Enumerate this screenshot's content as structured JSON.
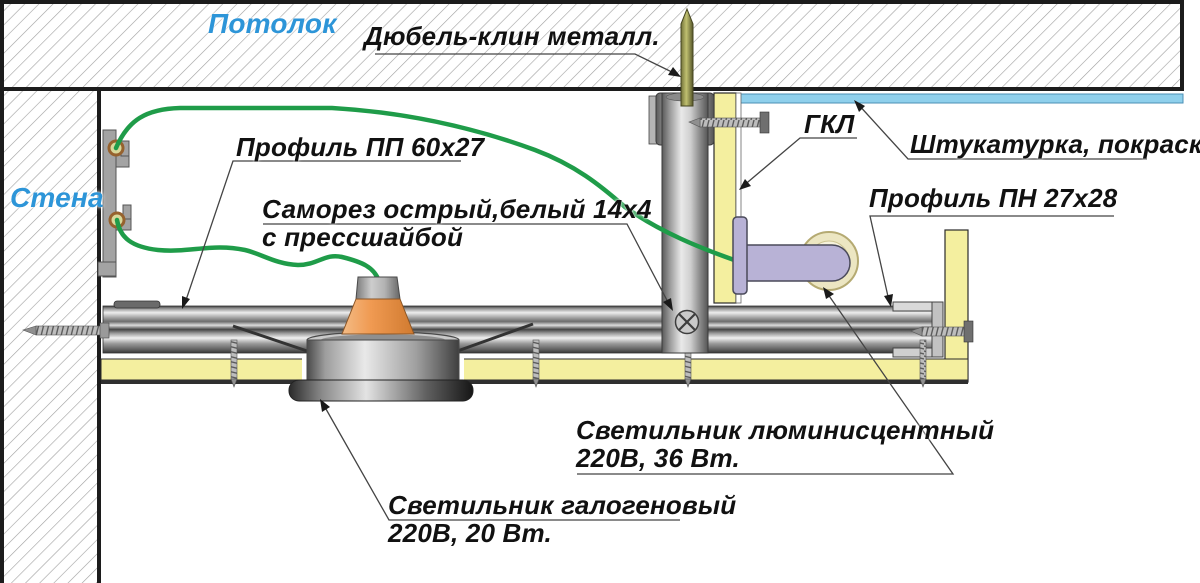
{
  "labels": {
    "ceiling": "Потолок",
    "wall": "Стена",
    "dowel": "Дюбель-клин металл.",
    "profile_pp": "Профиль ПП 60х27",
    "screw_line1": "Саморез острый,белый 14х4",
    "screw_line2": "с прессшайбой",
    "gkl": "ГКЛ",
    "plaster": "Штукатурка, покраска",
    "profile_pn": "Профиль ПН 27х28",
    "fluorescent_line1": "Светильник люминисцентный",
    "fluorescent_line2": "220В, 36 Вт.",
    "halogen_line1": "Светильник галогеновый",
    "halogen_line2": "220В, 20 Вт."
  },
  "colors": {
    "label_blue": "#2d95d8",
    "wire_green": "#1f9c49",
    "gypsum_yellow": "#f4ef9f",
    "plaster_blue": "#8fd0ec",
    "lamp_lavender": "#b8b2d6",
    "lamp_back_cream": "#ece6c2",
    "halogen_orange": "#ef9b52",
    "dowel_olive": "#9a9a55"
  }
}
